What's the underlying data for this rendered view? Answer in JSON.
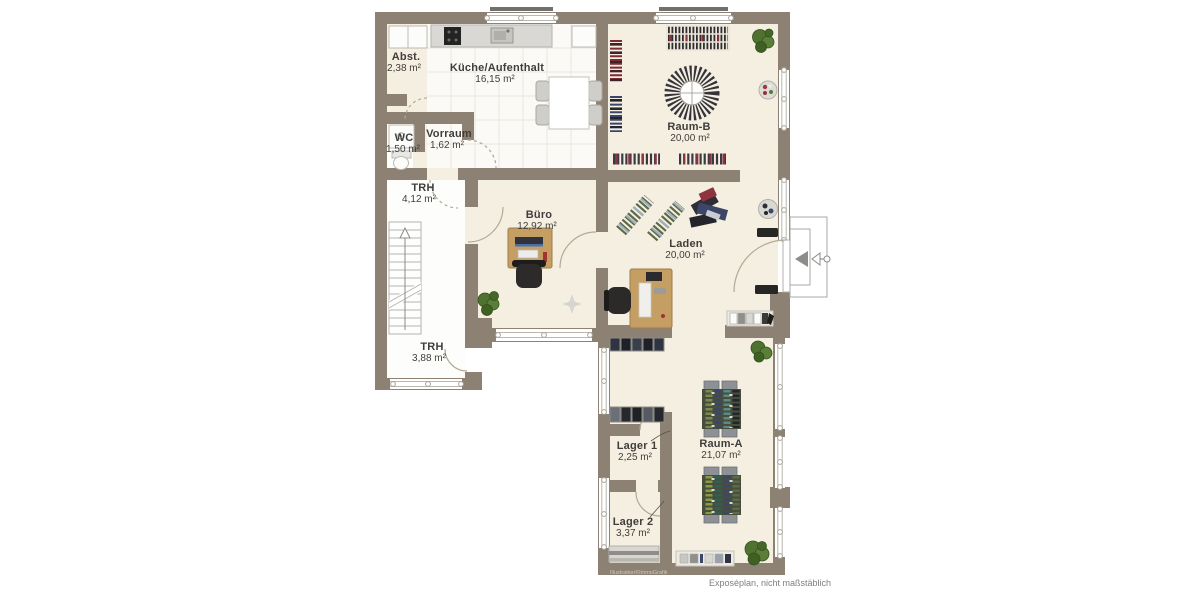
{
  "plan": {
    "caption": "Exposéplan, nicht maßstäblich",
    "watermark": "Illustration©ImmoGrafik",
    "colors": {
      "wall": "#8d8173",
      "floor": "#f5efe1",
      "tile_floor": "#fbfaf6",
      "stairwell_floor": "#fdfdfc",
      "wood": "#c59e63",
      "plant_green": "#4f7231",
      "clothes_dark": "#35343a",
      "clothes_red": "#8e3340",
      "clothes_navy": "#3c4668",
      "clothes_olive": "#5d6a48",
      "label_text": "#3f3e3c",
      "caption_text": "#7f7f7d"
    },
    "rooms": [
      {
        "id": "abst",
        "name": "Abst.",
        "area": "2,38 m²"
      },
      {
        "id": "kueche",
        "name": "Küche/Aufenthalt",
        "area": "16,15 m²"
      },
      {
        "id": "wc",
        "name": "WC",
        "area": "1,50 m²"
      },
      {
        "id": "vorraum",
        "name": "Vorraum",
        "area": "1,62 m²"
      },
      {
        "id": "trh-og",
        "name": "TRH",
        "area": "4,12 m²"
      },
      {
        "id": "buero",
        "name": "Büro",
        "area": "12,92 m²"
      },
      {
        "id": "raum-b",
        "name": "Raum-B",
        "area": "20,00 m²"
      },
      {
        "id": "laden",
        "name": "Laden",
        "area": "20,00 m²"
      },
      {
        "id": "trh-eg",
        "name": "TRH",
        "area": "3,88 m²"
      },
      {
        "id": "lager1",
        "name": "Lager 1",
        "area": "2,25 m²"
      },
      {
        "id": "raum-a",
        "name": "Raum-A",
        "area": "21,07 m²"
      },
      {
        "id": "lager2",
        "name": "Lager 2",
        "area": "3,37 m²"
      }
    ]
  }
}
